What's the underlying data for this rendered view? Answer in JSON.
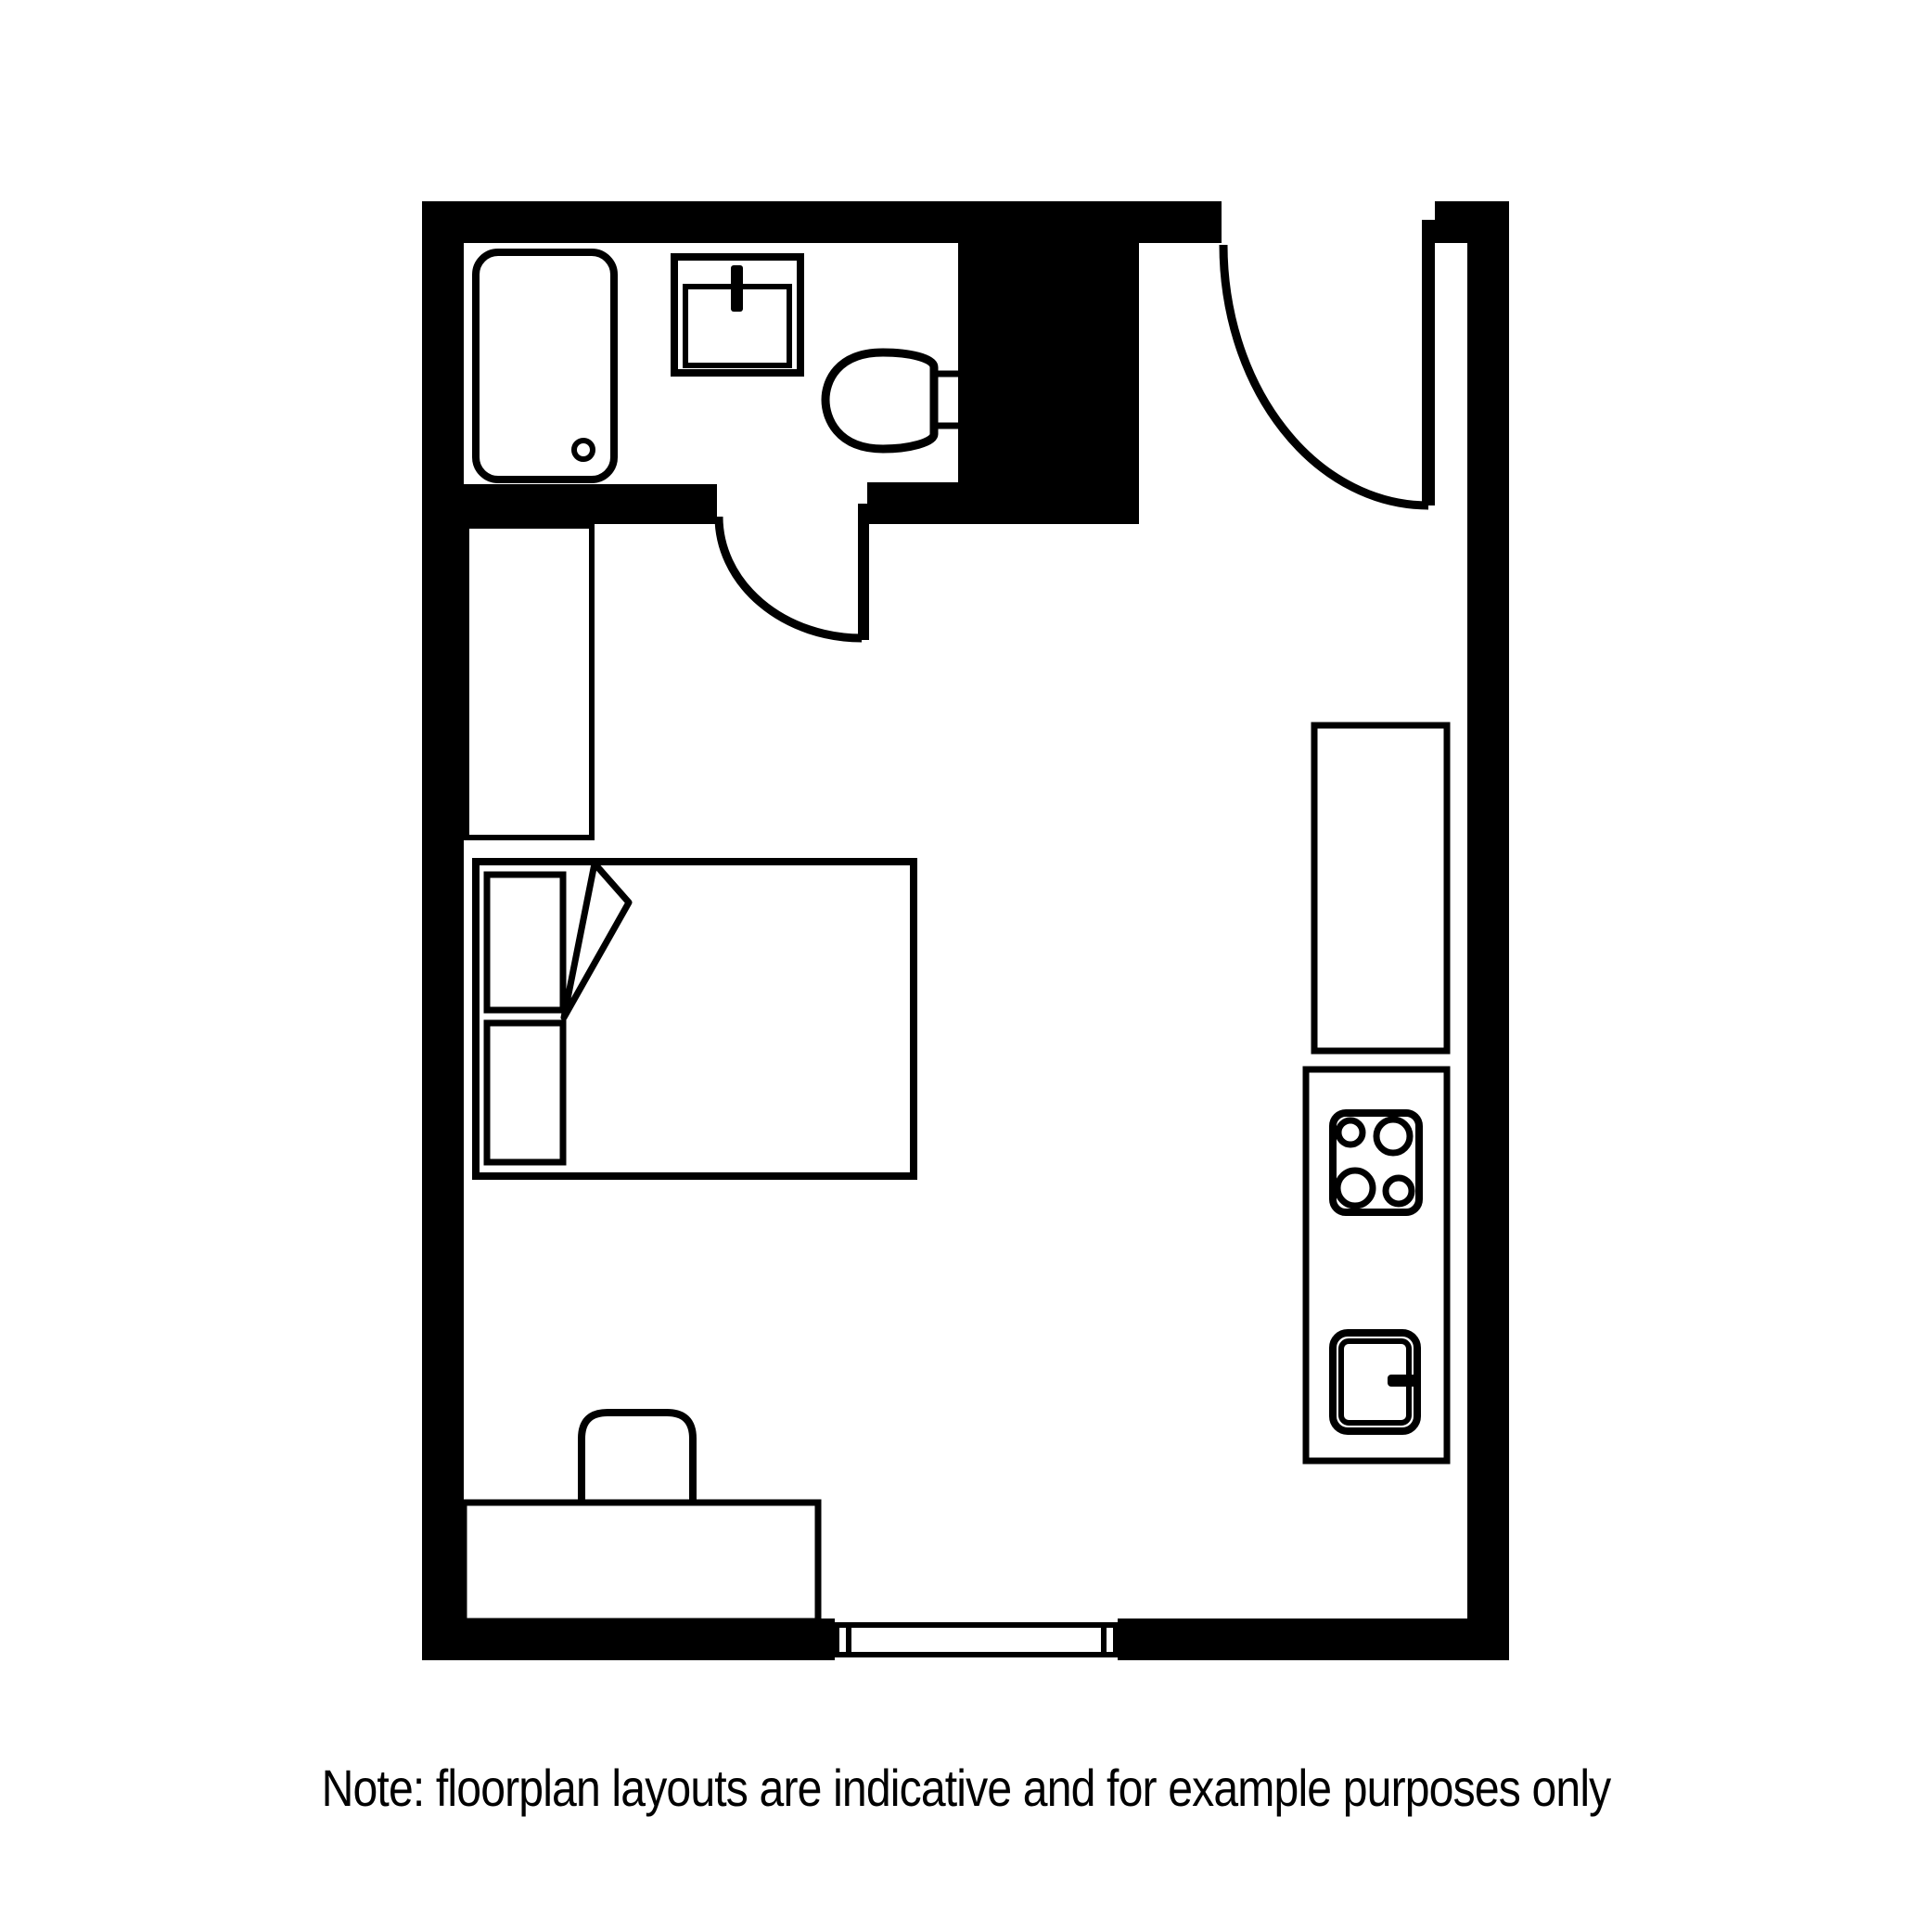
{
  "note_text": "Note: floorplan layouts are indicative and for example purposes only",
  "colors": {
    "line": "#000000",
    "background": "#ffffff"
  },
  "diagram": {
    "type": "floorplan",
    "subject": "studio apartment",
    "fixtures": [
      "bathtub",
      "bathroom-sink",
      "tap",
      "toilet",
      "service-shaft",
      "bathroom-door",
      "entry-door",
      "wardrobe",
      "double-bed",
      "pillows",
      "duvet-fold",
      "desk",
      "chair",
      "kitchen-counter",
      "stove-counter",
      "hob-with-4-burners",
      "kitchen-sink",
      "kitchen-tap",
      "window"
    ]
  }
}
